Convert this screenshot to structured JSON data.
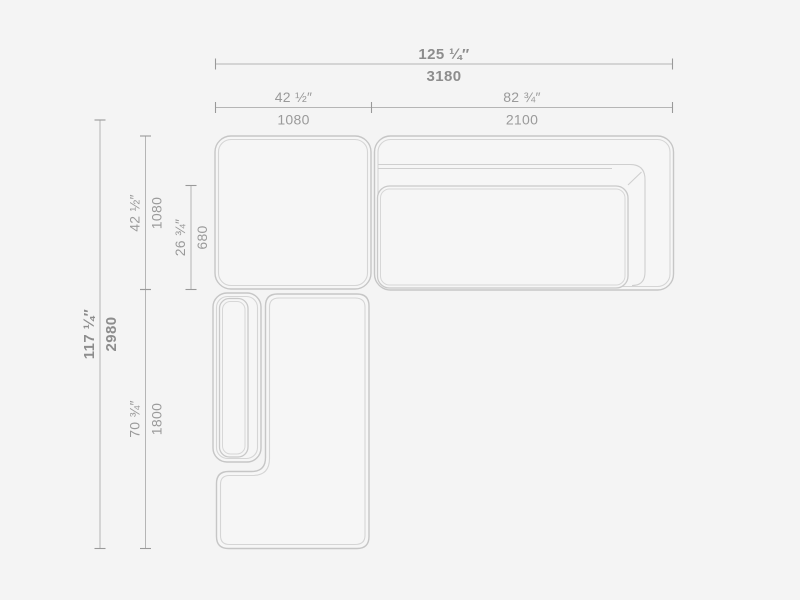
{
  "dims": {
    "overall_width": {
      "inches": "125 ¼″",
      "mm": "3180"
    },
    "corner_width": {
      "inches": "42 ½″",
      "mm": "1080"
    },
    "sofa_width": {
      "inches": "82 ¾″",
      "mm": "2100"
    },
    "overall_depth": {
      "inches": "117 ¼″",
      "mm": "2980"
    },
    "corner_depth": {
      "inches": "42 ½″",
      "mm": "1080"
    },
    "seat_depth": {
      "inches": "26 ¾″",
      "mm": "680"
    },
    "chaise_length": {
      "inches": "70 ¾″",
      "mm": "1800"
    }
  },
  "colors": {
    "background": "#f4f4f4",
    "module_fill": "#f6f6f6",
    "outline": "#c6c6c6",
    "outline_inner": "#d5d5d5",
    "dim_line": "#b5b5b5",
    "tick": "#999999",
    "text_primary": "#8d8d8d",
    "text_secondary": "#9a9a9a"
  }
}
